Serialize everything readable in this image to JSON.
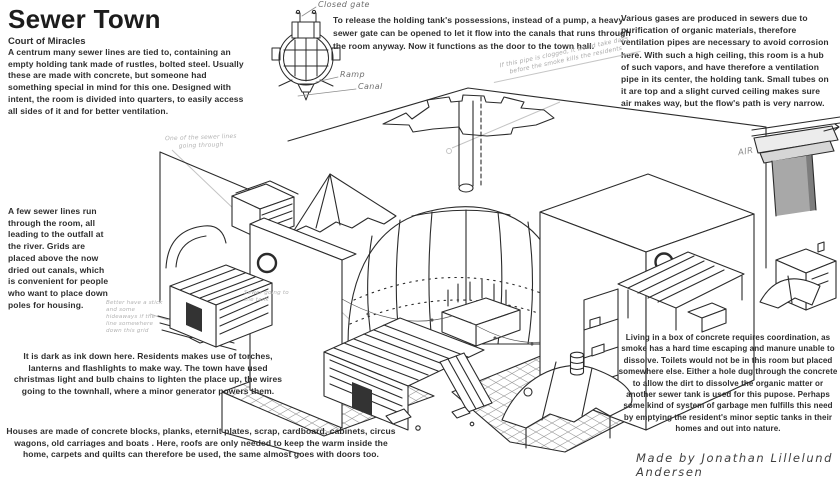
{
  "header": {
    "title": "Sewer Town",
    "subtitle": "Court of Miracles"
  },
  "paragraphs": {
    "intro": "A centrum many sewer lines are tied to, containing an empty holding tank made of rustles, bolted steel. Usually these are made with concrete, but someone had something special in mind for this one. Designed with intent, the room is divided into quarters, to easily access all sides of it and for better ventilation.",
    "gate": "To release the holding tank's possessions, instead of a pump, a heavy sewer gate can be opened to let it flow into the canals that runs through the room anyway. Now it functions as the door to the town hall.",
    "gases": "Various gases are produced in sewers due to purification of organic materials, therefore ventilation pipes are necessary to avoid corrosion here. With such a high ceiling, this room is a hub of such vapors, and have therefore a ventilation pipe in its center, the holding tank. Small tubes on it are top and a slight curved ceiling makes sure air makes way, but the flow's path is very narrow.",
    "sewer_lines": "A few sewer lines run through the room, all leading to the outfall at the river. Grids are placed above the now dried out canals, which is convenient for people who want to place down poles for housing.",
    "dark": "It is dark as ink down here. Residents makes use of torches, lanterns and flashlights to make way. The town have used christmas light and bulb chains to lighten the place up, the wires going to the townhall, where a minor generator powers them.",
    "houses": "Houses are made of concrete blocks, planks, eternit plates, scrap, cardboard, cabinets, circus wagons, old carriages and boats . Here, roofs are only needed to keep the warm inside the home, carpets and quilts can therefore be used, the same almost goes with doors too.",
    "living": "Living in a box of concrete requires coordination, as smoke has a hard time escaping and manure unable to dissolve. Toilets would not be in this room but placed somewhere else. Either a hole dug through the concrete to allow the dirt to dissolve the organic matter or another sewer tank is used for this pupose. Perhaps some kind of system of garbage men fulfills this need by emptying the resident's minor septic tanks in their homes and out into nature."
  },
  "labels": {
    "closed_gate": "Closed gate",
    "ramp": "Ramp",
    "canal": "Canal",
    "air": "AIR"
  },
  "notes": {
    "pipe_clogged": "If this pipe is clogged, it would take days before the smoke kills the residents",
    "sewer_line": "One of the sewer lines going through",
    "grid": "Better have a stick and some hideaways if the line somewhere down this grid",
    "tank": "Sewer going to the tank"
  },
  "signature": "Made by Jonathan Lillelund Andersen",
  "colors": {
    "ink": "#2b2b2b",
    "faint": "#c4c4c4",
    "handwriting": "#8d8d8d",
    "pillar_gray": "#a8a8a8",
    "background": "#ffffff"
  }
}
